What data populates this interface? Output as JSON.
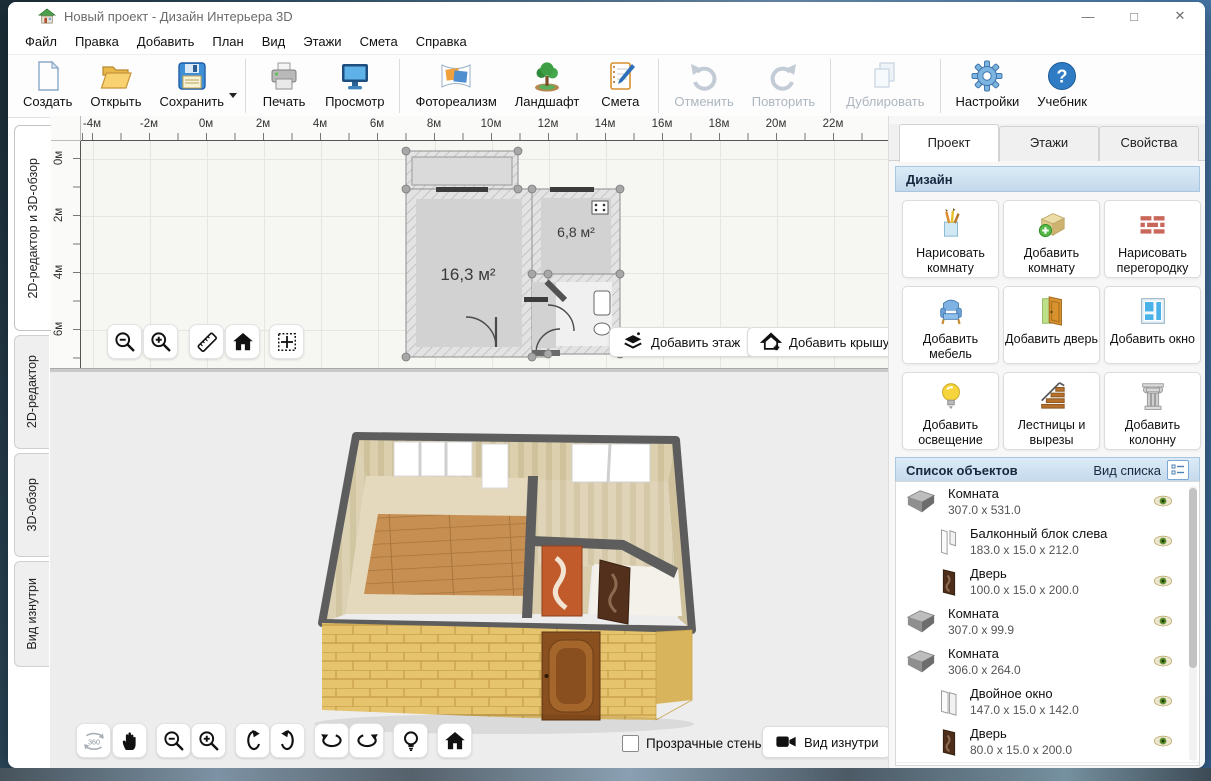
{
  "window": {
    "title": "Новый проект - Дизайн Интерьера 3D",
    "controls": {
      "minimize": "—",
      "maximize": "□",
      "close": "✕"
    },
    "menu": [
      "Файл",
      "Правка",
      "Добавить",
      "План",
      "Вид",
      "Этажи",
      "Смета",
      "Справка"
    ]
  },
  "toolbar": {
    "new": "Создать",
    "open": "Открыть",
    "save": "Сохранить",
    "print": "Печать",
    "preview": "Просмотр",
    "photorealism": "Фотореализм",
    "landscape": "Ландшафт",
    "estimate": "Смета",
    "undo": "Отменить",
    "redo": "Повторить",
    "duplicate": "Дублировать",
    "settings": "Настройки",
    "tutorial": "Учебник"
  },
  "left_tabs": [
    "2D-редактор и 3D-обзор",
    "2D-редактор",
    "3D-обзор",
    "Вид изнутри"
  ],
  "editor2d": {
    "ruler_h": [
      "-4м",
      "-2м",
      "0м",
      "2м",
      "4м",
      "6м",
      "8м",
      "10м",
      "12м",
      "14м",
      "16м",
      "18м",
      "20м",
      "22м"
    ],
    "ruler_v": [
      "0м",
      "2м",
      "4м",
      "6м"
    ],
    "rooms": {
      "large": "16,3 м²",
      "small": "6,8 м²"
    },
    "add_floor": "Добавить этаж",
    "add_roof": "Добавить крышу"
  },
  "viewer3d": {
    "btn_360": "360",
    "transparent_walls": "Прозрачные стены",
    "inside_view": "Вид изнутри"
  },
  "right_panel": {
    "tabs": [
      "Проект",
      "Этажи",
      "Свойства"
    ],
    "design_header": "Дизайн",
    "buttons": [
      "Нарисовать комнату",
      "Добавить комнату",
      "Нарисовать перегородку",
      "Добавить мебель",
      "Добавить дверь",
      "Добавить окно",
      "Добавить освещение",
      "Лестницы и вырезы",
      "Добавить колонну"
    ],
    "objects_header": "Список объектов",
    "list_view_label": "Вид списка",
    "objects": [
      {
        "name": "Комната",
        "size": "307.0 x 531.0"
      },
      {
        "name": "Балконный блок слева",
        "size": "183.0 x 15.0 x 212.0"
      },
      {
        "name": "Дверь",
        "size": "100.0 x 15.0 x 200.0"
      },
      {
        "name": "Комната",
        "size": "307.0 x 99.9"
      },
      {
        "name": "Комната",
        "size": "306.0 x 264.0"
      },
      {
        "name": "Двойное окно",
        "size": "147.0 x 15.0 x 142.0"
      },
      {
        "name": "Дверь",
        "size": "80.0 x 15.0 x 200.0"
      }
    ]
  },
  "colors": {
    "accent_blue": "#2f7cc4",
    "header_bar_blue": "#cfe0f1",
    "eye_green": "#5a8f2f",
    "brick_yellow": "#e2bd6a"
  }
}
